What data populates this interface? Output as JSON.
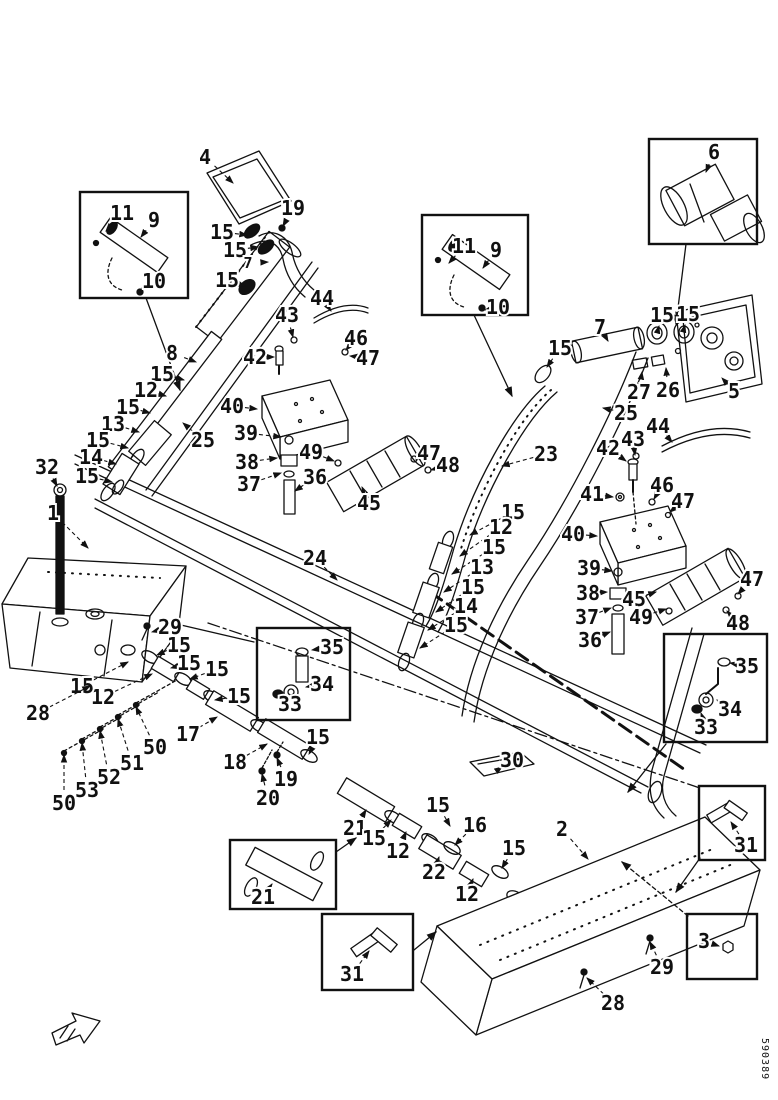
{
  "figure": {
    "code": "590389",
    "line_color": "#111111",
    "background": "#ffffff"
  },
  "direction_arrow": {
    "meaning": "direction-of-travel indicator"
  },
  "insets": [
    {
      "id": "inset-hose-clamp-left",
      "x": 80,
      "y": 192,
      "w": 108,
      "h": 106,
      "parts": [
        "11",
        "9",
        "10"
      ]
    },
    {
      "id": "inset-hose-clamp-right",
      "x": 422,
      "y": 215,
      "w": 106,
      "h": 100,
      "parts": [
        "11",
        "9",
        "10"
      ]
    },
    {
      "id": "inset-muffler-6",
      "x": 649,
      "y": 139,
      "w": 108,
      "h": 105,
      "parts": [
        "6"
      ]
    },
    {
      "id": "inset-fitting-left",
      "x": 257,
      "y": 628,
      "w": 93,
      "h": 92,
      "parts": [
        "35",
        "34",
        "33"
      ]
    },
    {
      "id": "inset-fitting-right",
      "x": 664,
      "y": 634,
      "w": 103,
      "h": 108,
      "parts": [
        "35",
        "34",
        "33"
      ]
    },
    {
      "id": "inset-pipe-21",
      "x": 230,
      "y": 840,
      "w": 106,
      "h": 69,
      "parts": [
        "21"
      ]
    },
    {
      "id": "inset-clamp-31-center",
      "x": 322,
      "y": 914,
      "w": 91,
      "h": 76,
      "parts": [
        "31"
      ]
    },
    {
      "id": "inset-clamp-31-right",
      "x": 699,
      "y": 786,
      "w": 66,
      "h": 74,
      "parts": [
        "31"
      ]
    },
    {
      "id": "inset-bolt-3",
      "x": 687,
      "y": 914,
      "w": 70,
      "h": 65,
      "parts": [
        "3"
      ]
    }
  ],
  "callouts": [
    {
      "l": "4",
      "x": 205,
      "y": 157,
      "tx": 233,
      "ty": 183
    },
    {
      "l": "15",
      "x": 222,
      "y": 232,
      "tx": 247,
      "ty": 235
    },
    {
      "l": "19",
      "x": 293,
      "y": 208,
      "tx": 283,
      "ty": 226
    },
    {
      "l": "15",
      "x": 235,
      "y": 250,
      "tx": 258,
      "ty": 247
    },
    {
      "l": "7",
      "x": 248,
      "y": 263,
      "tx": 268,
      "ty": 262,
      "s": 15
    },
    {
      "l": "15",
      "x": 227,
      "y": 280,
      "tx": 245,
      "ty": 286
    },
    {
      "l": "44",
      "x": 322,
      "y": 298,
      "tx": 331,
      "ty": 311
    },
    {
      "l": "43",
      "x": 287,
      "y": 315,
      "tx": 293,
      "ty": 337
    },
    {
      "l": "46",
      "x": 356,
      "y": 338,
      "tx": 346,
      "ty": 350
    },
    {
      "l": "47",
      "x": 368,
      "y": 358,
      "tx": 350,
      "ty": 356
    },
    {
      "l": "42",
      "x": 255,
      "y": 357,
      "tx": 274,
      "ty": 357
    },
    {
      "l": "8",
      "x": 172,
      "y": 353,
      "tx": 196,
      "ty": 362
    },
    {
      "l": "15",
      "x": 162,
      "y": 374,
      "tx": 184,
      "ty": 380
    },
    {
      "l": "12",
      "x": 146,
      "y": 390,
      "tx": 166,
      "ty": 396
    },
    {
      "l": "15",
      "x": 128,
      "y": 407,
      "tx": 150,
      "ty": 413
    },
    {
      "l": "13",
      "x": 113,
      "y": 424,
      "tx": 139,
      "ty": 432
    },
    {
      "l": "15",
      "x": 98,
      "y": 440,
      "tx": 128,
      "ty": 448
    },
    {
      "l": "14",
      "x": 91,
      "y": 457,
      "tx": 116,
      "ty": 464
    },
    {
      "l": "15",
      "x": 87,
      "y": 476,
      "tx": 112,
      "ty": 482
    },
    {
      "l": "25",
      "x": 203,
      "y": 440,
      "tx": 183,
      "ty": 423
    },
    {
      "l": "32",
      "x": 47,
      "y": 467,
      "tx": 57,
      "ty": 486
    },
    {
      "l": "1",
      "x": 53,
      "y": 513,
      "tx": 88,
      "ty": 548
    },
    {
      "l": "11",
      "x": 122,
      "y": 213,
      "tx": 106,
      "ty": 231
    },
    {
      "l": "9",
      "x": 154,
      "y": 220,
      "tx": 141,
      "ty": 237
    },
    {
      "l": "10",
      "x": 154,
      "y": 281,
      "tx": 142,
      "ty": 288
    },
    {
      "l": "11",
      "x": 464,
      "y": 246,
      "tx": 449,
      "ty": 263
    },
    {
      "l": "9",
      "x": 496,
      "y": 250,
      "tx": 483,
      "ty": 268
    },
    {
      "l": "10",
      "x": 498,
      "y": 307,
      "tx": 485,
      "ty": 310
    },
    {
      "l": "6",
      "x": 714,
      "y": 152,
      "tx": 706,
      "ty": 172
    },
    {
      "l": "7",
      "x": 600,
      "y": 327,
      "tx": 608,
      "ty": 341
    },
    {
      "l": "15",
      "x": 560,
      "y": 348,
      "tx": 547,
      "ty": 367
    },
    {
      "l": "15",
      "x": 662,
      "y": 315,
      "tx": 659,
      "ty": 326
    },
    {
      "l": "15",
      "x": 688,
      "y": 314,
      "tx": 685,
      "ty": 325
    },
    {
      "l": "27",
      "x": 639,
      "y": 392,
      "tx": 642,
      "ty": 372
    },
    {
      "l": "26",
      "x": 668,
      "y": 390,
      "tx": 666,
      "ty": 368
    },
    {
      "l": "5",
      "x": 734,
      "y": 391,
      "tx": 722,
      "ty": 378
    },
    {
      "l": "25",
      "x": 626,
      "y": 413,
      "tx": 603,
      "ty": 408
    },
    {
      "l": "23",
      "x": 546,
      "y": 454,
      "tx": 502,
      "ty": 466
    },
    {
      "l": "15",
      "x": 513,
      "y": 512,
      "tx": 470,
      "ty": 535
    },
    {
      "l": "12",
      "x": 501,
      "y": 527,
      "tx": 460,
      "ty": 556
    },
    {
      "l": "15",
      "x": 494,
      "y": 547,
      "tx": 452,
      "ty": 574
    },
    {
      "l": "13",
      "x": 482,
      "y": 567,
      "tx": 444,
      "ty": 592
    },
    {
      "l": "15",
      "x": 473,
      "y": 587,
      "tx": 436,
      "ty": 612
    },
    {
      "l": "14",
      "x": 466,
      "y": 606,
      "tx": 428,
      "ty": 630
    },
    {
      "l": "15",
      "x": 456,
      "y": 625,
      "tx": 420,
      "ty": 648
    },
    {
      "l": "44",
      "x": 658,
      "y": 426,
      "tx": 672,
      "ty": 442
    },
    {
      "l": "43",
      "x": 633,
      "y": 439,
      "tx": 635,
      "ty": 455
    },
    {
      "l": "42",
      "x": 608,
      "y": 448,
      "tx": 626,
      "ty": 461
    },
    {
      "l": "41",
      "x": 592,
      "y": 494,
      "tx": 613,
      "ty": 497
    },
    {
      "l": "46",
      "x": 662,
      "y": 485,
      "tx": 654,
      "ty": 499
    },
    {
      "l": "47",
      "x": 683,
      "y": 501,
      "tx": 670,
      "ty": 512
    },
    {
      "l": "40",
      "x": 573,
      "y": 534,
      "tx": 597,
      "ty": 536
    },
    {
      "l": "39",
      "x": 589,
      "y": 568,
      "tx": 612,
      "ty": 571
    },
    {
      "l": "38",
      "x": 588,
      "y": 593,
      "tx": 607,
      "ty": 592
    },
    {
      "l": "37",
      "x": 587,
      "y": 617,
      "tx": 611,
      "ty": 608
    },
    {
      "l": "36",
      "x": 590,
      "y": 640,
      "tx": 610,
      "ty": 632
    },
    {
      "l": "45",
      "x": 634,
      "y": 599,
      "tx": 656,
      "ty": 592
    },
    {
      "l": "49",
      "x": 641,
      "y": 617,
      "tx": 666,
      "ty": 609
    },
    {
      "l": "47",
      "x": 752,
      "y": 579,
      "tx": 738,
      "ty": 594
    },
    {
      "l": "48",
      "x": 738,
      "y": 623,
      "tx": 727,
      "ty": 611
    },
    {
      "l": "40",
      "x": 232,
      "y": 406,
      "tx": 257,
      "ty": 409
    },
    {
      "l": "39",
      "x": 246,
      "y": 433,
      "tx": 281,
      "ty": 437
    },
    {
      "l": "38",
      "x": 247,
      "y": 462,
      "tx": 277,
      "ty": 458
    },
    {
      "l": "37",
      "x": 249,
      "y": 484,
      "tx": 281,
      "ty": 473
    },
    {
      "l": "36",
      "x": 315,
      "y": 477,
      "tx": 295,
      "ty": 491
    },
    {
      "l": "49",
      "x": 311,
      "y": 452,
      "tx": 334,
      "ty": 461
    },
    {
      "l": "45",
      "x": 369,
      "y": 503,
      "tx": 362,
      "ty": 487
    },
    {
      "l": "47",
      "x": 429,
      "y": 453,
      "tx": 416,
      "ty": 459
    },
    {
      "l": "48",
      "x": 448,
      "y": 465,
      "tx": 431,
      "ty": 470
    },
    {
      "l": "24",
      "x": 315,
      "y": 558,
      "tx": 337,
      "ty": 580
    },
    {
      "l": "30",
      "x": 512,
      "y": 760,
      "tx": 502,
      "ty": 767
    },
    {
      "l": "35",
      "x": 332,
      "y": 647,
      "tx": 312,
      "ty": 650
    },
    {
      "l": "34",
      "x": 322,
      "y": 684,
      "tx": 306,
      "ty": 687
    },
    {
      "l": "33",
      "x": 290,
      "y": 704,
      "tx": 283,
      "ty": 697
    },
    {
      "l": "35",
      "x": 747,
      "y": 666,
      "tx": 730,
      "ty": 663
    },
    {
      "l": "34",
      "x": 730,
      "y": 709,
      "tx": 717,
      "ty": 700
    },
    {
      "l": "33",
      "x": 706,
      "y": 727,
      "tx": 701,
      "ty": 713
    },
    {
      "l": "29",
      "x": 170,
      "y": 627,
      "tx": 152,
      "ty": 632
    },
    {
      "l": "15",
      "x": 179,
      "y": 645,
      "tx": 157,
      "ty": 655
    },
    {
      "l": "15",
      "x": 189,
      "y": 663,
      "tx": 171,
      "ty": 668
    },
    {
      "l": "15",
      "x": 217,
      "y": 669,
      "tx": 190,
      "ty": 679
    },
    {
      "l": "15",
      "x": 239,
      "y": 696,
      "tx": 215,
      "ty": 700
    },
    {
      "l": "12",
      "x": 103,
      "y": 697,
      "tx": 152,
      "ty": 674
    },
    {
      "l": "15",
      "x": 82,
      "y": 686,
      "tx": 128,
      "ty": 662
    },
    {
      "l": "28",
      "x": 38,
      "y": 713,
      "tx": 90,
      "ty": 686
    },
    {
      "l": "17",
      "x": 188,
      "y": 734,
      "tx": 217,
      "ty": 717
    },
    {
      "l": "18",
      "x": 235,
      "y": 762,
      "tx": 267,
      "ty": 744
    },
    {
      "l": "19",
      "x": 286,
      "y": 779,
      "tx": 277,
      "ty": 758
    },
    {
      "l": "20",
      "x": 268,
      "y": 798,
      "tx": 262,
      "ty": 774
    },
    {
      "l": "50",
      "x": 155,
      "y": 747,
      "tx": 136,
      "ty": 707
    },
    {
      "l": "51",
      "x": 132,
      "y": 763,
      "tx": 118,
      "ty": 719
    },
    {
      "l": "52",
      "x": 109,
      "y": 777,
      "tx": 100,
      "ty": 731
    },
    {
      "l": "53",
      "x": 87,
      "y": 790,
      "tx": 82,
      "ty": 743
    },
    {
      "l": "50",
      "x": 64,
      "y": 803,
      "tx": 64,
      "ty": 755
    },
    {
      "l": "15",
      "x": 318,
      "y": 737,
      "tx": 309,
      "ty": 754
    },
    {
      "l": "21",
      "x": 355,
      "y": 828,
      "tx": 366,
      "ty": 810
    },
    {
      "l": "15",
      "x": 374,
      "y": 838,
      "tx": 391,
      "ty": 820
    },
    {
      "l": "12",
      "x": 398,
      "y": 851,
      "tx": 406,
      "ty": 832
    },
    {
      "l": "22",
      "x": 434,
      "y": 872,
      "tx": 439,
      "ty": 857
    },
    {
      "l": "12",
      "x": 467,
      "y": 894,
      "tx": 473,
      "ty": 879
    },
    {
      "l": "16",
      "x": 475,
      "y": 825,
      "tx": 455,
      "ty": 845
    },
    {
      "l": "15",
      "x": 438,
      "y": 805,
      "tx": 450,
      "ty": 826
    },
    {
      "l": "15",
      "x": 514,
      "y": 848,
      "tx": 502,
      "ty": 868
    },
    {
      "l": "2",
      "x": 562,
      "y": 829,
      "tx": 588,
      "ty": 859
    },
    {
      "l": "29",
      "x": 662,
      "y": 967,
      "tx": 650,
      "ty": 942
    },
    {
      "l": "28",
      "x": 613,
      "y": 1003,
      "tx": 587,
      "ty": 978
    },
    {
      "l": "31",
      "x": 746,
      "y": 845,
      "tx": 731,
      "ty": 822
    },
    {
      "l": "3",
      "x": 704,
      "y": 941,
      "tx": 719,
      "ty": 946
    },
    {
      "l": "31",
      "x": 352,
      "y": 974,
      "tx": 369,
      "ty": 951
    },
    {
      "l": "21",
      "x": 263,
      "y": 897,
      "tx": 272,
      "ty": 884
    }
  ]
}
